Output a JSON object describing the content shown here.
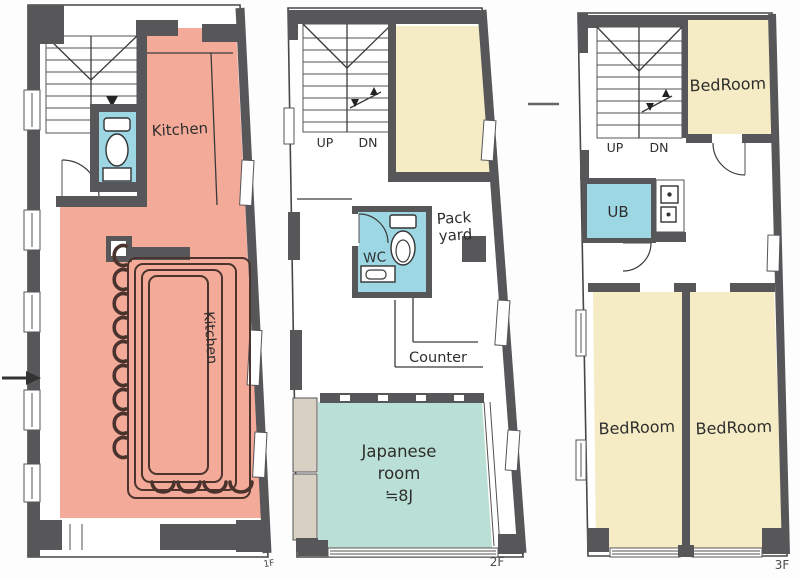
{
  "document": {
    "type": "architectural-floor-plan",
    "building_floors": 3
  },
  "colors": {
    "wall_gray": "#57575a",
    "kitchen_pink": "#f3aa99",
    "room_cream": "#f5ecc5",
    "japanese_teal": "#badfd4",
    "wet_area_blue": "#9ed7e4",
    "balcony_tan": "#d8d1c3",
    "stool_brown": "#4a332c",
    "label_text": "#2e2e2e"
  },
  "floors": {
    "f1": {
      "name_label": "1F",
      "kitchen": "Kitchen",
      "kitchen_vertical": "Kitchen"
    },
    "f2": {
      "name_label": "2F",
      "up": "UP",
      "dn": "DN",
      "wc": "WC",
      "pack_line1": "Pack",
      "pack_line2": "yard",
      "counter": "Counter",
      "japanese_line1": "Japanese",
      "japanese_line2": "room",
      "japanese_line3": "≒8J"
    },
    "f3": {
      "name_label": "3F",
      "up": "UP",
      "dn": "DN",
      "ub": "UB",
      "bedroom_top": "BedRoom",
      "bedroom_left": "BedRoom",
      "bedroom_right": "BedRoom"
    }
  }
}
